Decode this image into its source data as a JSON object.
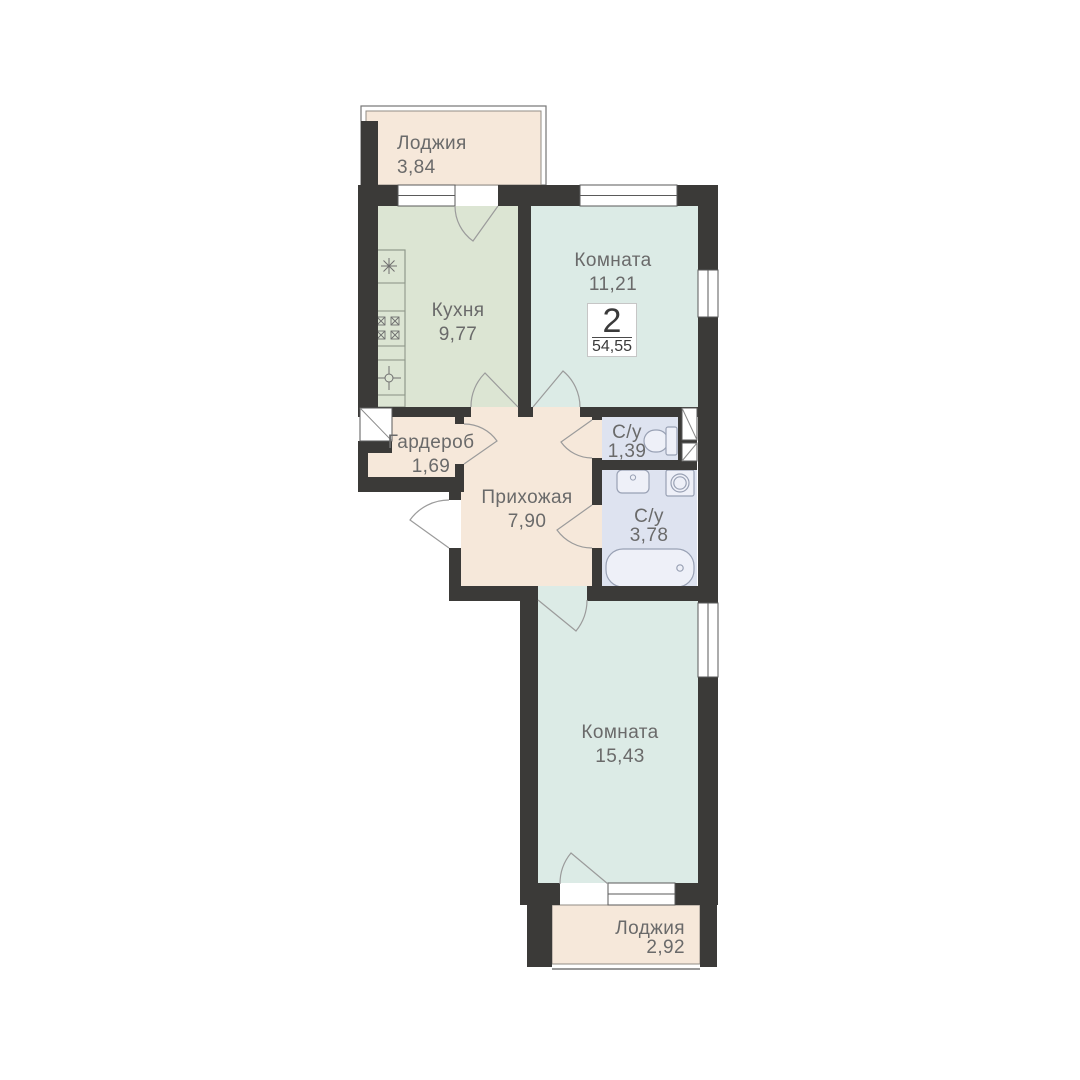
{
  "plan": {
    "badge": {
      "rooms_count": "2",
      "total_area": "54,55"
    },
    "rooms": [
      {
        "id": "loggia-top",
        "name": "Лоджия",
        "area": "3,84"
      },
      {
        "id": "kitchen",
        "name": "Кухня",
        "area": "9,77"
      },
      {
        "id": "room-1",
        "name": "Комната",
        "area": "11,21"
      },
      {
        "id": "wardrobe",
        "name": "Гардероб",
        "area": "1,69"
      },
      {
        "id": "hallway",
        "name": "Прихожая",
        "area": "7,90"
      },
      {
        "id": "wc-1",
        "name": "С/у",
        "area": "1,39"
      },
      {
        "id": "wc-2",
        "name": "С/у",
        "area": "3,78"
      },
      {
        "id": "room-2",
        "name": "Комната",
        "area": "15,43"
      },
      {
        "id": "loggia-bottom",
        "name": "Лоджия",
        "area": "2,92"
      }
    ],
    "colors": {
      "wall": "#3b3a38",
      "living_fill": "#dcebe6",
      "kitchen_fill": "#dce5d3",
      "wet_fill": "#dee3f0",
      "corridor_fill": "#f6e8da",
      "label_text": "#6a6a6a",
      "door_arc": "#9b9b9b",
      "fixture_stroke": "#99a1b4"
    },
    "fixtures": [
      "kitchen-sink",
      "kitchen-stove",
      "kitchen-appliance",
      "toilet",
      "washbasin",
      "washing-machine",
      "bathtub",
      "vent-shaft"
    ]
  }
}
